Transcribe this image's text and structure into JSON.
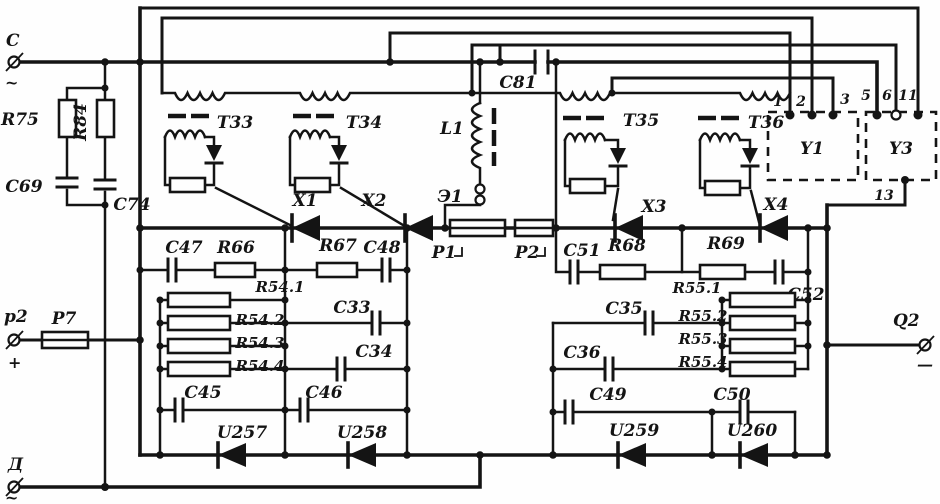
{
  "terminals": {
    "c": {
      "label": "C",
      "sub": "~"
    },
    "p2": {
      "label": "p2",
      "sub": "+"
    },
    "d": {
      "label": "Д",
      "sub": "~"
    },
    "q2": {
      "label": "Q2",
      "sub": "—"
    }
  },
  "resistors": {
    "r75": "R75",
    "r84": "R84",
    "r66": "R66",
    "r67": "R67",
    "r68": "R68",
    "r69": "R69",
    "r54_1": "R54.1",
    "r54_2": "R54.2",
    "r54_3": "R54.3",
    "r54_4": "R54.4",
    "r55_1": "R55.1",
    "r55_2": "R55.2",
    "r55_3": "R55.3",
    "r55_4": "R55.4"
  },
  "capacitors": {
    "c69": "C69",
    "c74": "C74",
    "c81": "C81",
    "c47": "C47",
    "c48": "C48",
    "c51": "C51",
    "c52": "C52",
    "c33": "C33",
    "c34": "C34",
    "c35": "C35",
    "c36": "C36",
    "c45": "C45",
    "c46": "C46",
    "c49": "C49",
    "c50": "C50"
  },
  "transformers": {
    "t33": "T33",
    "t34": "T34",
    "t35": "T35",
    "t36": "T36"
  },
  "inductor": {
    "l1": "L1",
    "e1": "Э1"
  },
  "thyristors": {
    "x1": "X1",
    "x2": "X2",
    "x3": "X3",
    "x4": "X4"
  },
  "diodes": {
    "u257": "U257",
    "u258": "U258",
    "u259": "U259",
    "u260": "U260"
  },
  "shunts": {
    "p1": "P1",
    "p2": "P2",
    "p7": "P7"
  },
  "modules": {
    "y1": "Y1",
    "y3": "Y3",
    "pins": {
      "n1": "1",
      "n2": "2",
      "n3": "3",
      "n5": "5",
      "n6": "6",
      "n11": "11",
      "n13": "13"
    }
  },
  "colors": {
    "ink": "#141414",
    "paper": "#fefefe"
  }
}
